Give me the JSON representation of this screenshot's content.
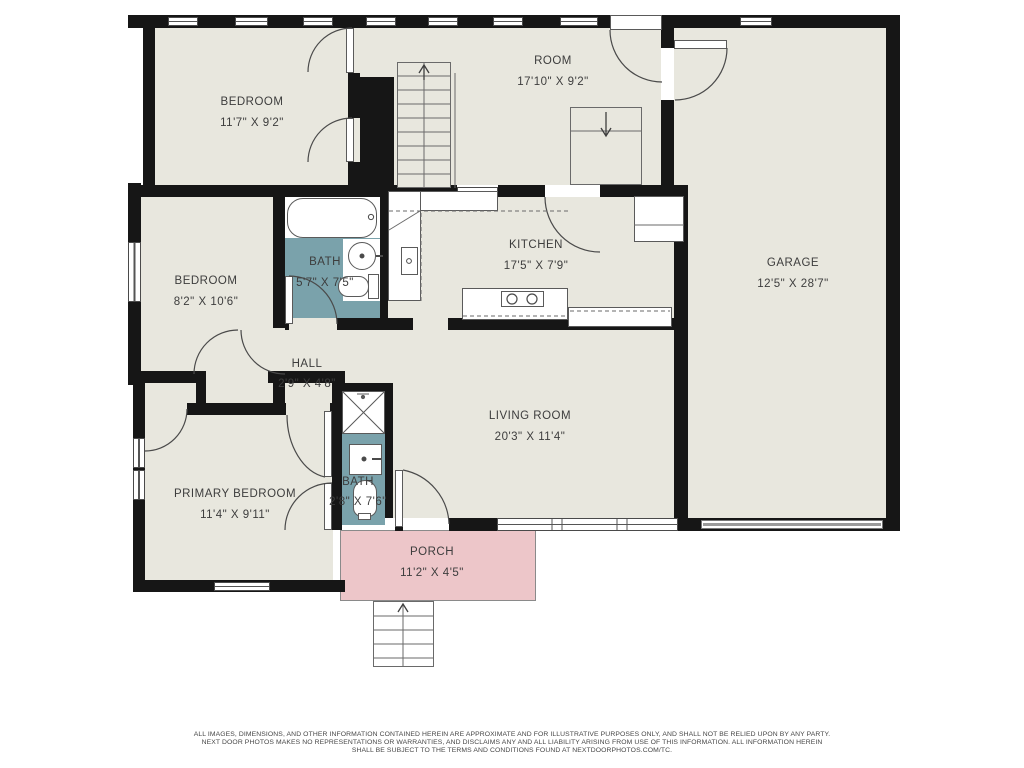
{
  "palette": {
    "floor": "#e8e7de",
    "wall": "#161616",
    "bath_floor": "#7aa2ab",
    "porch_floor": "#edc6c9",
    "linework": "#4a4a4a"
  },
  "rooms": [
    {
      "name": "BEDROOM",
      "dims": "11'7\" X 9'2\""
    },
    {
      "name": "ROOM",
      "dims": "17'10\" X 9'2\""
    },
    {
      "name": "GARAGE",
      "dims": "12'5\" X 28'7\""
    },
    {
      "name": "BEDROOM",
      "dims": "8'2\" X 10'6\""
    },
    {
      "name": "BATH",
      "dims": "5'7\" X 7'5\""
    },
    {
      "name": "KITCHEN",
      "dims": "17'5\" X 7'9\""
    },
    {
      "name": "HALL",
      "dims": "2'9\" X 4'8\""
    },
    {
      "name": "LIVING ROOM",
      "dims": "20'3\" X 11'4\""
    },
    {
      "name": "PRIMARY BEDROOM",
      "dims": "11'4\" X 9'11\""
    },
    {
      "name": "BATH",
      "dims": "2'8\" X 7'6\""
    },
    {
      "name": "PORCH",
      "dims": "11'2\" X 4'5\""
    }
  ],
  "icons": {
    "stairs_up": "up-arrow",
    "stairs_down": "down-arrow",
    "porch_steps": "up-arrow",
    "shower": "crossed-square"
  },
  "disclaimer": {
    "line1": "ALL IMAGES, DIMENSIONS, AND OTHER INFORMATION CONTAINED HEREIN ARE APPROXIMATE AND FOR ILLUSTRATIVE PURPOSES ONLY, AND SHALL NOT BE RELIED UPON BY ANY PARTY.",
    "line2": "NEXT DOOR PHOTOS MAKES NO REPRESENTATIONS OR WARRANTIES, AND DISCLAIMS ANY AND ALL LIABILITY ARISING FROM USE OF THIS INFORMATION. ALL INFORMATION HEREIN",
    "line3": "SHALL BE SUBJECT TO THE TERMS AND CONDITIONS FOUND AT NEXTDOORPHOTOS.COM/TC."
  }
}
